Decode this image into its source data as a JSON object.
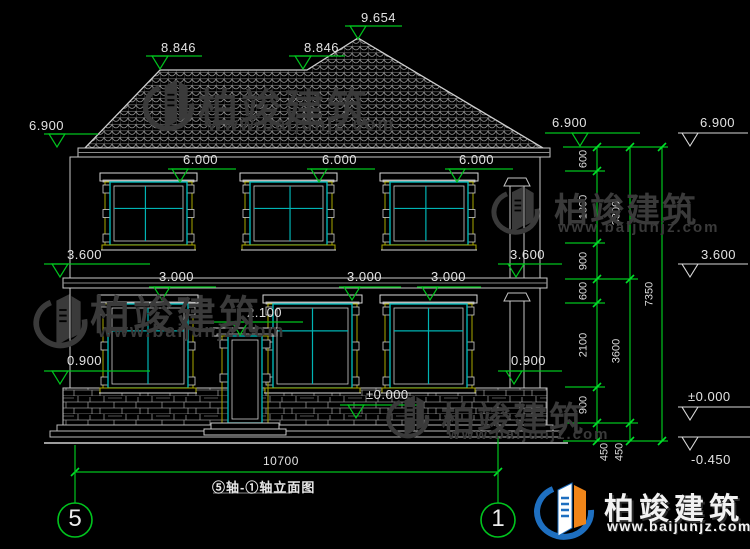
{
  "drawing": {
    "levels": {
      "peak": "9.654",
      "ridge_left": "8.846",
      "ridge_mid": "8.846",
      "eave_left": "6.900",
      "eave_right": "6.900",
      "eave_far": "6.900",
      "floor2_windows": [
        "6.000",
        "6.000",
        "6.000"
      ],
      "floor2_left": "3.600",
      "floor2_right": "3.600",
      "floor2_far": "3.600",
      "floor1_windows": [
        "3.000",
        "3.000",
        "3.000"
      ],
      "door_top": "2.100",
      "sill_left": "0.900",
      "sill_right": "0.900",
      "ground_center": "±0.000",
      "ground_far": "±0.000",
      "foundation_far": "-0.450"
    },
    "right_chain": {
      "col1": [
        "600",
        "1800",
        "900",
        "600",
        "2100",
        "900",
        "450"
      ],
      "col2": [
        "3300",
        "3600",
        "450"
      ],
      "col3": [
        "7350"
      ]
    },
    "overall_width": "10700",
    "axis_left": "5",
    "axis_right": "1",
    "title": "⑤轴-①轴立面图"
  },
  "watermark": {
    "brand": "柏竣建筑",
    "site": "www.baijunjz.com"
  },
  "footer_logo": {
    "brand": "柏竣建筑",
    "site": "www.baijunjz.com"
  },
  "colors": {
    "background": "#000000",
    "line": "#d6d6d6",
    "dimension_green": "#00c41e",
    "window_cyan": "#00b3b3",
    "trim_yellow": "#a8a800",
    "watermark_gray": "#3a3a3a",
    "logo_blue": "#1e6fc0",
    "logo_orange": "#f08519"
  }
}
